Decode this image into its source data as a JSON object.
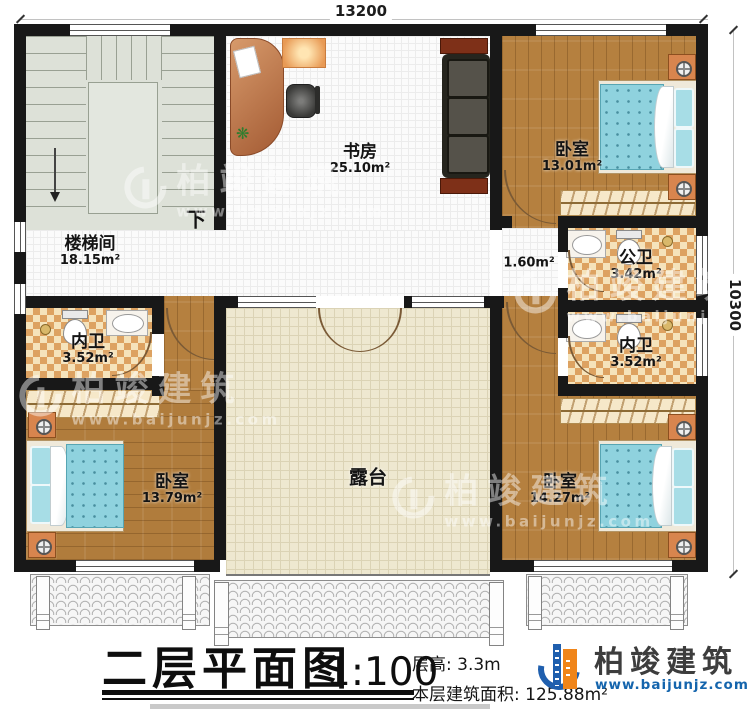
{
  "dimensions": {
    "top": "13200",
    "right": "10300"
  },
  "rooms": {
    "stairwell": {
      "name": "楼梯间",
      "area": "18.15m²"
    },
    "study": {
      "name": "书房",
      "area": "25.10m²"
    },
    "bedroom_top_right": {
      "name": "卧室",
      "area": "13.01m²"
    },
    "vestibule": {
      "area": "1.60m²"
    },
    "public_bath": {
      "name": "公卫",
      "area": "3.42m²"
    },
    "ensuite_right": {
      "name": "内卫",
      "area": "3.52m²"
    },
    "ensuite_left": {
      "name": "内卫",
      "area": "3.52m²"
    },
    "bedroom_bottom_left": {
      "name": "卧室",
      "area": "13.79m²"
    },
    "bedroom_bottom_right": {
      "name": "卧室",
      "area": "14.27m²"
    },
    "terrace": {
      "name": "露台"
    }
  },
  "annotations": {
    "stairs_down": "下"
  },
  "icons": {
    "plant_glyph": "❋"
  },
  "watermark": {
    "name": "柏竣建筑",
    "url": "www.baijunjz.com"
  },
  "title_block": {
    "title": "二层平面图",
    "scale": "1:100",
    "floor_height_label": "层高:",
    "floor_height_value": "3.3m",
    "floor_area_label": "本层建筑面积:",
    "floor_area_value": "125.88m²"
  },
  "brand": {
    "name": "柏竣建筑",
    "url": "www.baijunjz.com"
  },
  "colors": {
    "wall": "#181818",
    "wood": "#b5803f",
    "bath_accent": "#dda261",
    "terrace": "#eee8d0",
    "bed": "#8fd2de",
    "brand_blue": "#1f5fae",
    "brand_orange": "#f08519"
  }
}
